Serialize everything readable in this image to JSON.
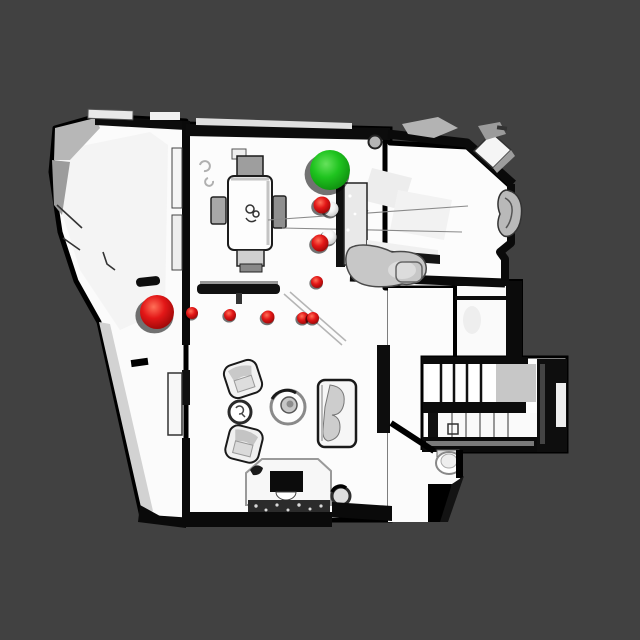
{
  "scene": {
    "type": "topdown-3d-scan-view",
    "background_color": "#414141",
    "floor_color": "#fbfbfb",
    "wall_color": "#0a0a0a",
    "canvas_width": 640,
    "canvas_height": 640
  },
  "markers": {
    "goal": {
      "label": "goal-sphere",
      "color": "#1fc41f",
      "x": 330,
      "y": 170,
      "r": 20
    },
    "start": {
      "label": "start-sphere",
      "color": "#e31717",
      "x": 157,
      "y": 312,
      "r": 17
    },
    "waypoint_color": "#e31717",
    "waypoints": [
      {
        "x": 192,
        "y": 313,
        "r": 6
      },
      {
        "x": 230,
        "y": 315,
        "r": 6
      },
      {
        "x": 268,
        "y": 317,
        "r": 6.5
      },
      {
        "x": 303,
        "y": 318,
        "r": 6
      },
      {
        "x": 313,
        "y": 318,
        "r": 6
      },
      {
        "x": 317,
        "y": 282,
        "r": 6
      }
    ],
    "capped_waypoints": [
      {
        "red": {
          "x": 322,
          "y": 205,
          "r": 8.5
        },
        "white": {
          "x": 331,
          "y": 209,
          "r": 7.5
        }
      },
      {
        "red": {
          "x": 320,
          "y": 243,
          "r": 8.5
        },
        "white": {
          "x": 329,
          "y": 237,
          "r": 7.5
        }
      }
    ],
    "styles": {
      "red": {
        "highlight": "#ff7058",
        "base": "#e31717",
        "dark": "#8f0505"
      },
      "green": {
        "highlight": "#66e25c",
        "base": "#1fc41f",
        "dark": "#0c860c"
      },
      "white": {
        "highlight": "#ffffff",
        "base": "#f4f4f4",
        "dark": "#c2c2c2"
      }
    }
  }
}
